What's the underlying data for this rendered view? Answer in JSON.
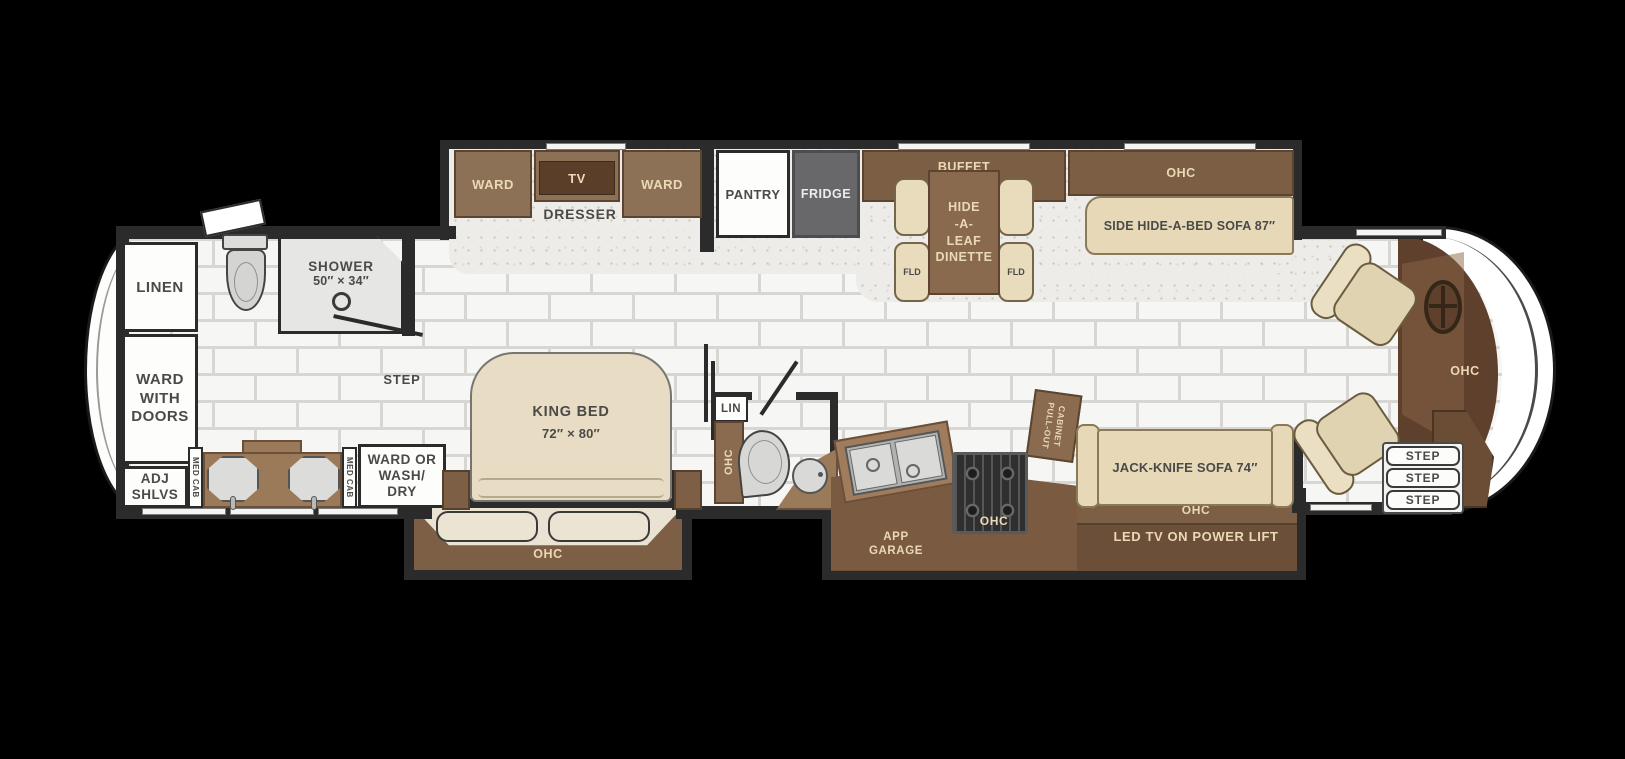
{
  "title": "RV floor plan",
  "colors": {
    "background": "#000000",
    "wall": "#2b2b2b",
    "cabinet_brown": "#8d7157",
    "cabinet_dark_brown": "#5f4330",
    "counter_brown": "#9b7a5a",
    "cream_furniture": "#e7d9b8",
    "fridge_gray": "#68686b",
    "tile_floor": "#f6f6f4",
    "label_dark": "#4a4a48",
    "label_cream": "#ead9b5"
  },
  "rear": {
    "linen": "LINEN",
    "ward_doors_1": "WARD",
    "ward_doors_2": "WITH",
    "ward_doors_3": "DOORS",
    "adj_shlvs_1": "ADJ",
    "adj_shlvs_2": "SHLVS",
    "med_cab_left": "MED CAB",
    "med_cab_right": "MED CAB",
    "wash_dry_1": "WARD OR",
    "wash_dry_2": "WASH/",
    "wash_dry_3": "DRY",
    "shower": "SHOWER",
    "shower_size": "50″ × 34″",
    "step": "STEP"
  },
  "bedroom": {
    "ward_left": "WARD",
    "tv": "TV",
    "ward_right": "WARD",
    "dresser": "DRESSER",
    "king_bed": "KING BED",
    "king_size": "72″ × 80″",
    "ohc": "OHC"
  },
  "galley": {
    "pantry": "PANTRY",
    "fridge": "FRIDGE",
    "buffet": "BUFFET",
    "buffet_ohc": "OHC",
    "dinette_1": "HIDE",
    "dinette_2": "-A-",
    "dinette_3": "LEAF",
    "dinette_4": "DINETTE",
    "fld_left": "FLD",
    "fld_right": "FLD"
  },
  "half_bath": {
    "lin": "LIN",
    "ohc": "OHC"
  },
  "kitchen": {
    "ohc": "OHC",
    "app_garage_1": "APP",
    "app_garage_2": "GARAGE",
    "pull_out_1": "PULL-OUT",
    "pull_out_2": "CABINET"
  },
  "living": {
    "sofa_ohc": "OHC",
    "side_sofa": "SIDE HIDE-A-BED SOFA 87″",
    "jack_sofa": "JACK-KNIFE SOFA 74″",
    "ohc": "OHC",
    "led_tv": "LED TV ON POWER LIFT"
  },
  "front": {
    "ohc": "OHC",
    "step_1": "STEP",
    "step_2": "STEP",
    "step_3": "STEP"
  }
}
